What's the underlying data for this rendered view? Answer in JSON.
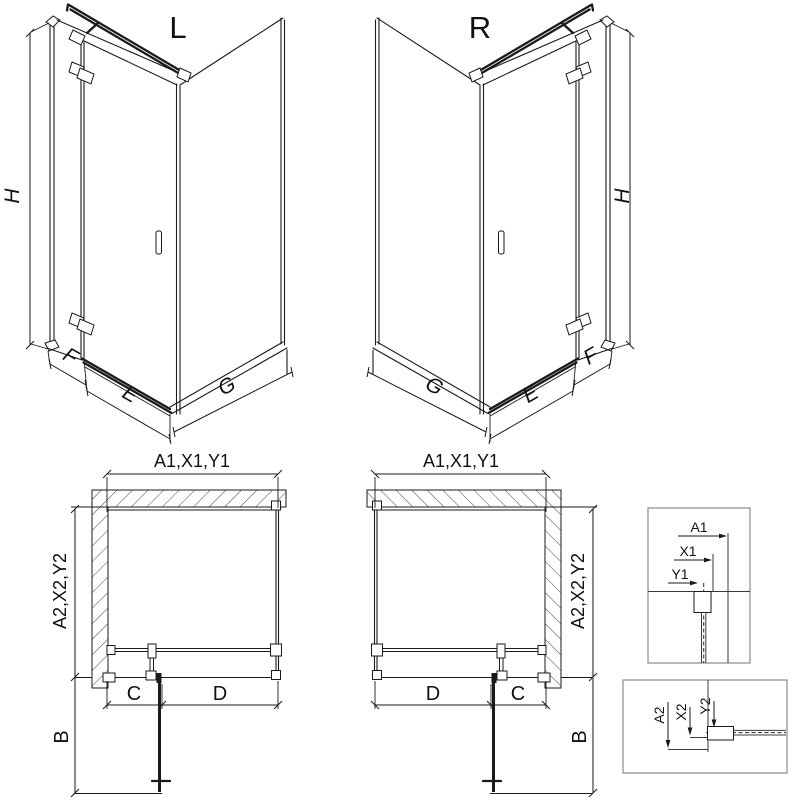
{
  "diagram": {
    "left_view": {
      "title": "L",
      "height": "H",
      "segment_fixed": "F",
      "segment_door": "E",
      "segment_side": "G"
    },
    "right_view": {
      "title": "R",
      "height": "H",
      "segment_fixed": "F",
      "segment_door": "E",
      "segment_side": "G"
    },
    "left_plan": {
      "width_top": "A1,X1,Y1",
      "depth_side": "A2,X2,Y2",
      "fixed_width": "C",
      "door_width": "D",
      "door_open_depth": "B"
    },
    "right_plan": {
      "width_top": "A1,X1,Y1",
      "depth_side": "A2,X2,Y2",
      "fixed_width": "C",
      "door_width": "D",
      "door_open_depth": "B"
    },
    "detail_width": {
      "outer": "A1",
      "mid": "X1",
      "inner": "Y1"
    },
    "detail_depth": {
      "outer": "A2",
      "mid": "X2",
      "inner": "Y2"
    }
  },
  "colors": {
    "line": "#1a1a1a",
    "detail_frame": "#8a8a8a",
    "background": "#ffffff"
  }
}
